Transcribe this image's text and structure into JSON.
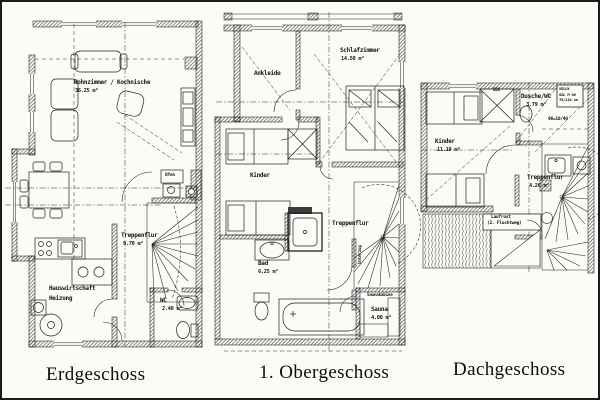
{
  "sheet": {
    "captions": {
      "erdgeschoss": "Erdgeschoss",
      "obergeschoss": "1. Obergeschoss",
      "dachgeschoss": "Dachgeschoss"
    }
  },
  "plans": {
    "erdgeschoss": {
      "rooms": {
        "wohnzimmer": {
          "name": "Wohnzimmer / Kochnische",
          "area": "36.25 m²"
        },
        "treppenflur": {
          "name": "Treppenflur",
          "area": "9.70 m²"
        },
        "hauswirtschaft": {
          "line1": "Hauswirtschaft",
          "line2": "Heizung"
        },
        "wc": {
          "name": "WC",
          "area": "2.40 m²"
        }
      },
      "annotations": {
        "ofen": "Ofen"
      }
    },
    "obergeschoss": {
      "rooms": {
        "ankleide": {
          "name": "Ankleide"
        },
        "schlafzimmer": {
          "name": "Schlafzimmer",
          "area": "14.50 m²"
        },
        "kinder": {
          "name": "Kinder"
        },
        "treppenflur": {
          "name": "Treppenflur"
        },
        "bad": {
          "name": "Bad",
          "area": "6.25 m²"
        },
        "sauna": {
          "name": "Sauna",
          "area": "4.00 m²"
        }
      },
      "annotations": {
        "saunakabine": "Saunakabine",
        "unterzug": "Unterzug"
      }
    },
    "dachgeschoss": {
      "rooms": {
        "kinder": {
          "name": "Kinder",
          "area": "11.19 m²"
        },
        "dusche_wc": {
          "name": "Dusche/WC",
          "area": "3.79 m²"
        },
        "treppenflur": {
          "name": "Treppenflur",
          "area": "4.26 m²"
        }
      },
      "annotations": {
        "ebs": "EBS",
        "velux1": "VELUX",
        "velux2": "GGL M 06",
        "velux3": "78/118 cm",
        "rafter_dim": "96=10/40",
        "laufrost1": "Laufrost",
        "laufrost2": "(2. Fluchtweg)"
      }
    }
  },
  "colors": {
    "ink": "#1c1c1c",
    "paper": "#fbfbf8"
  }
}
